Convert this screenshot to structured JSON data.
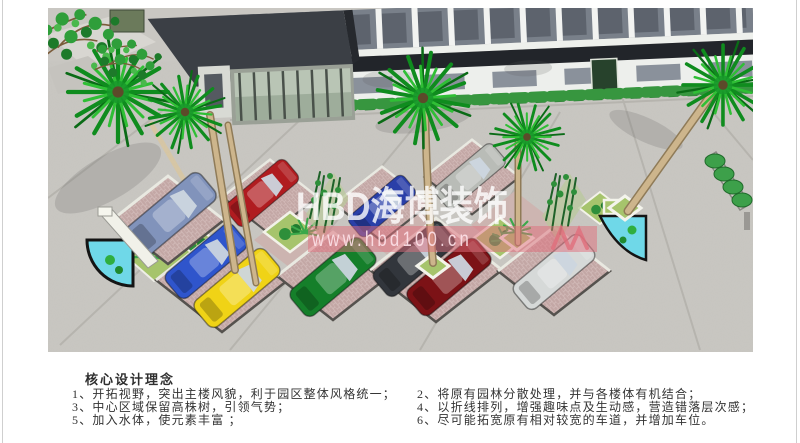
{
  "watermark": {
    "brand": "HBD海博装饰",
    "url": "www.hbd100.cn",
    "band_color": "#e06e7c",
    "text_color": "#ffffff"
  },
  "caption": {
    "heading": "核心设计理念",
    "notes_left": [
      "1、开拓视野，突出主楼风貌，利于园区整体风格统一；",
      "3、中心区域保留高株树，引领气势；",
      "5、加入水体，使元素丰富 ；"
    ],
    "notes_right": [
      "2、将原有园林分散处理，并与各楼体有机结合；",
      "4、以折线排列，增强趣味点及生动感，营造错落层次感；",
      "6、尽可能拓宽原有相对较宽的车道，并增加车位。"
    ]
  },
  "scene": {
    "colors": {
      "pavement": "#c9c7c2",
      "stall_brick": "#c3a7a5",
      "lawn": "#a6c46c",
      "water": "#6fd8e8",
      "palm": "#129a24",
      "hedge": "#37963f",
      "building_dark": "#23262b",
      "facade": "#edefec"
    },
    "cars": [
      {
        "name": "steel-blue-sedan",
        "color": "#8193bb"
      },
      {
        "name": "red-car",
        "color": "#b01c20"
      },
      {
        "name": "blue-convertible",
        "color": "#2f55cc"
      },
      {
        "name": "yellow-sports-car",
        "color": "#f0d316"
      },
      {
        "name": "green-sports-car",
        "color": "#157f2a"
      },
      {
        "name": "blue-car",
        "color": "#2a3fa8"
      },
      {
        "name": "gray-car",
        "color": "#b9bcb7"
      },
      {
        "name": "black-car",
        "color": "#32363c"
      },
      {
        "name": "maroon-car",
        "color": "#7c1216"
      },
      {
        "name": "silver-car",
        "color": "#d6d9d8"
      }
    ]
  }
}
